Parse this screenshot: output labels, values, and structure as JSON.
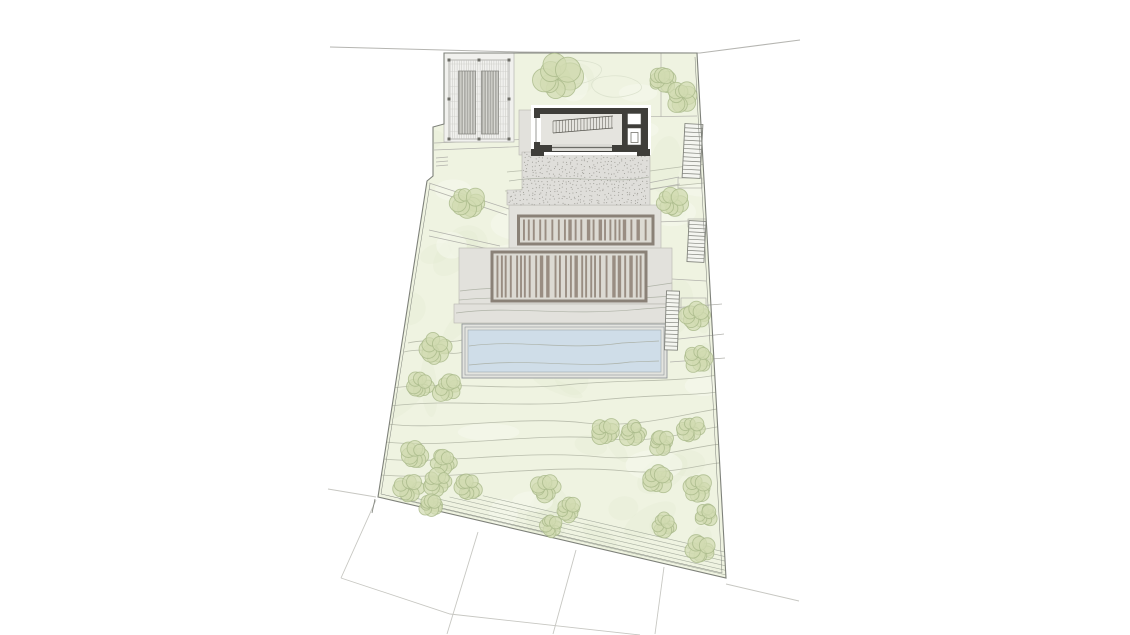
{
  "document": {
    "type": "architectural-site-plan",
    "description": "Site and roof plan drawing of a hillside villa: pergola carport, dark roof volume with skylights, stippled terrace, two louvered roof decks, swimming pool and landscaped sloping garden with trees, contour lines and neighbouring parcels",
    "visible_text": []
  },
  "canvas": {
    "width": 1130,
    "height": 635,
    "background": "#ffffff"
  },
  "colors": {
    "background": "#ffffff",
    "lawn": "#eff3e1",
    "lawn_texture_dark": "#e3ead0",
    "lawn_texture_light": "#f7f9f0",
    "contour": "#b2b7a6",
    "contour_over": "#a6aa9d",
    "boundary": "#7e817a",
    "faint": "#b2b2ac",
    "neighbor": "#c7c7c2",
    "road": "#b5b5b1",
    "hardscape_fill": "#e2e1dc",
    "hardscape_edge": "#b7b6b0",
    "stipple_fill": "#dfdeda",
    "stipple_dot": "#92918a",
    "louver_frame": "#8a8177",
    "louver_bg": "#dcdad3",
    "louver_slat": "#95897d",
    "building_dark": "#3f3e3a",
    "building_floor": "#e5e4df",
    "pool_water": "#cfdde8",
    "pool_edge": "#8f9598",
    "pool_band": "#e3e4df",
    "tree_fill": "#d1dbb1",
    "tree_edge": "#a9b989",
    "stair_line": "#82847d",
    "stair_fill": "#f4f5f0",
    "terrace_line": "#9aa194",
    "carport_slab": "#f1f1ee",
    "carport_hatch": "#c3c3be",
    "carport_band": "#d7d7d2",
    "carport_band_line": "#82827c",
    "post": "#6d6d67"
  },
  "site": {
    "parcel_outline": [
      [
        444,
        53
      ],
      [
        697,
        53
      ],
      [
        726,
        578
      ],
      [
        378,
        497
      ],
      [
        427,
        181
      ],
      [
        433,
        176
      ],
      [
        433,
        127
      ],
      [
        444,
        124
      ]
    ],
    "inner_edge_lines": [
      [
        381,
        494,
        722,
        573
      ],
      [
        695,
        57,
        722,
        573
      ],
      [
        430,
        184,
        381,
        494
      ]
    ],
    "corner_notch": [
      375,
      499,
      372,
      513
    ],
    "road_polyline": [
      [
        330,
        47
      ],
      [
        520,
        52
      ],
      [
        700,
        53
      ],
      [
        800,
        40
      ]
    ],
    "neighbor_lines": [
      [
        [
          328,
          489
        ],
        [
          376,
          497
        ]
      ],
      [
        [
          376,
          500
        ],
        [
          341,
          578
        ]
      ],
      [
        [
          341,
          578
        ],
        [
          450,
          614
        ],
        [
          640,
          635
        ]
      ],
      [
        [
          478,
          532
        ],
        [
          447,
          634
        ]
      ],
      [
        [
          576,
          550
        ],
        [
          553,
          634
        ]
      ],
      [
        [
          664,
          567
        ],
        [
          655,
          634
        ]
      ],
      [
        [
          726,
          584
        ],
        [
          799,
          601
        ]
      ]
    ],
    "faint_lines": [
      [
        661,
        53,
        661,
        117
      ],
      [
        630,
        117,
        697,
        116
      ],
      [
        648,
        183,
        679,
        177
      ],
      [
        648,
        190,
        680,
        184
      ],
      [
        655,
        222,
        688,
        221
      ],
      [
        672,
        279,
        706,
        281
      ],
      [
        434,
        143,
        534,
        139
      ],
      [
        434,
        150,
        534,
        146
      ],
      [
        436,
        158,
        448,
        157
      ],
      [
        436,
        162,
        448,
        161
      ],
      [
        436,
        166,
        448,
        165
      ],
      [
        429,
        183,
        509,
        209
      ],
      [
        429,
        189,
        507,
        215
      ],
      [
        429,
        230,
        500,
        246
      ],
      [
        429,
        236,
        498,
        251
      ],
      [
        672,
        308,
        722,
        304
      ],
      [
        670,
        340,
        724,
        334
      ],
      [
        670,
        362,
        725,
        358
      ]
    ],
    "faint_rects": [
      [
        678,
        178,
        24,
        10
      ],
      [
        688,
        219,
        18,
        8
      ],
      [
        681,
        298,
        25,
        21
      ]
    ],
    "blob_outlines": [
      "M545,65 q20,-8 45,-3 q18,4 8,14 q-15,12 -40,6 q-20,-6 -13,-17 z",
      "M598,78 q25,-6 40,4 q10,8 -8,13 q-22,6 -35,-4 q-8,-8 3,-13 z"
    ],
    "terrace_steps": {
      "count": 6,
      "start": [
        378,
        497
      ],
      "end": [
        726,
        578
      ],
      "first_inset": 3,
      "inset_step": 4.4
    }
  },
  "contours": {
    "under": [
      "M404,352 C430,346 448,357 463,352",
      "M408,343 C430,338 448,344 462,340",
      "M392,388 C450,381 505,391 565,385 C620,379 680,383 722,374",
      "M390,406 C455,398 520,409 590,401 C650,394 700,396 723,391",
      "M388,424 C440,431 520,415 585,423 C640,429 690,412 724,408",
      "M386,442 C450,449 540,431 612,439 C660,444 700,428 724,426",
      "M384,459 C440,465 525,449 600,457 C650,462 700,444 725,444",
      "M381,475 C450,481 545,463 625,471 C675,476 710,461 726,463",
      "M507,172 C560,166 605,177 650,171 C680,167 700,164 708,164",
      "M505,191 C560,185 625,195 663,187 L704,183"
    ],
    "over": [
      "M509,181 C560,173 612,185 649,177",
      "M460,291 C520,283 565,295 645,287 L672,283",
      "M459,300 C525,294 605,302 671,296",
      "M456,313 C512,305 562,317 642,309 L670,307",
      "M469,346 C522,339 565,351 622,343 L659,341",
      "M469,365 C532,358 582,369 630,362 L659,361"
    ]
  },
  "vegetation": {
    "trees": [
      [
        558,
        78,
        21
      ],
      [
        663,
        80,
        12
      ],
      [
        682,
        97,
        14
      ],
      [
        467,
        203,
        15
      ],
      [
        672,
        203,
        14
      ],
      [
        695,
        315,
        13
      ],
      [
        699,
        359,
        13
      ],
      [
        435,
        348,
        15
      ],
      [
        420,
        385,
        13
      ],
      [
        448,
        388,
        13
      ],
      [
        605,
        432,
        13
      ],
      [
        633,
        433,
        12
      ],
      [
        661,
        442,
        12
      ],
      [
        690,
        429,
        13
      ],
      [
        415,
        455,
        13
      ],
      [
        444,
        462,
        13
      ],
      [
        409,
        489,
        14
      ],
      [
        438,
        483,
        13
      ],
      [
        468,
        488,
        12
      ],
      [
        431,
        505,
        11
      ],
      [
        546,
        489,
        13
      ],
      [
        569,
        510,
        12
      ],
      [
        552,
        526,
        11
      ],
      [
        658,
        479,
        13
      ],
      [
        697,
        487,
        13
      ],
      [
        664,
        525,
        12
      ],
      [
        701,
        549,
        13
      ],
      [
        706,
        515,
        11
      ]
    ]
  },
  "structures": {
    "carport": {
      "slab": [
        444,
        53,
        70,
        89
      ],
      "hatch_rect": [
        449,
        60,
        60,
        79
      ],
      "bands": [
        [
          458.5,
          71,
          17,
          63
        ],
        [
          481.5,
          71,
          17,
          63
        ]
      ],
      "post_size": 3,
      "posts": [
        [
          449,
          60
        ],
        [
          509,
          60
        ],
        [
          449,
          139
        ],
        [
          509,
          139
        ],
        [
          449,
          99
        ],
        [
          509,
          99
        ],
        [
          479,
          60
        ],
        [
          479,
          139
        ]
      ]
    },
    "building": {
      "surround": [
        531,
        105,
        120,
        50
      ],
      "body": [
        534,
        108,
        114,
        44
      ],
      "floor": [
        540,
        114,
        82,
        31
      ],
      "left_opening": [
        533,
        118,
        8,
        24
      ],
      "glass_strip": [
        552,
        144,
        60,
        7
      ],
      "skylight_a": [
        627.5,
        113.5,
        13.5,
        11
      ],
      "skylight_b": [
        627.5,
        128,
        13.5,
        17
      ],
      "skylight_b_inner": [
        631,
        132.5,
        7,
        10
      ],
      "feet": [
        [
          531,
          149,
          13,
          7
        ],
        [
          637,
          149,
          13,
          7
        ]
      ],
      "stair_hatch": {
        "x0": 553,
        "y0": 121,
        "x1": 613,
        "y1": 116,
        "h": 12,
        "step": 3.1
      }
    },
    "stipple_terrace": {
      "polygon": [
        [
          522,
          152
        ],
        [
          650,
          152
        ],
        [
          650,
          205
        ],
        [
          507,
          205
        ],
        [
          507,
          190
        ],
        [
          522,
          190
        ]
      ],
      "bbox": [
        507,
        152,
        143,
        53
      ],
      "dot_step": 3.8
    },
    "platforms": [
      [
        519,
        110,
        15,
        45
      ],
      [
        509,
        205,
        152,
        45
      ],
      [
        459,
        248,
        213,
        56
      ],
      [
        454,
        304,
        216,
        19
      ]
    ],
    "louvered_roofs": [
      [
        518.5,
        216,
        134.5,
        28
      ],
      [
        492,
        252,
        154,
        49
      ]
    ],
    "pool": {
      "outer": [
        462,
        324,
        205,
        54
      ],
      "mid": [
        465,
        327,
        199,
        48
      ],
      "water": [
        468,
        330,
        193,
        42
      ]
    },
    "stairs": [
      [
        683.5,
        124,
        18,
        54,
        13,
        3
      ],
      [
        688,
        221,
        17,
        41,
        11,
        3
      ],
      [
        665.5,
        291,
        13,
        59,
        15,
        2
      ]
    ]
  }
}
